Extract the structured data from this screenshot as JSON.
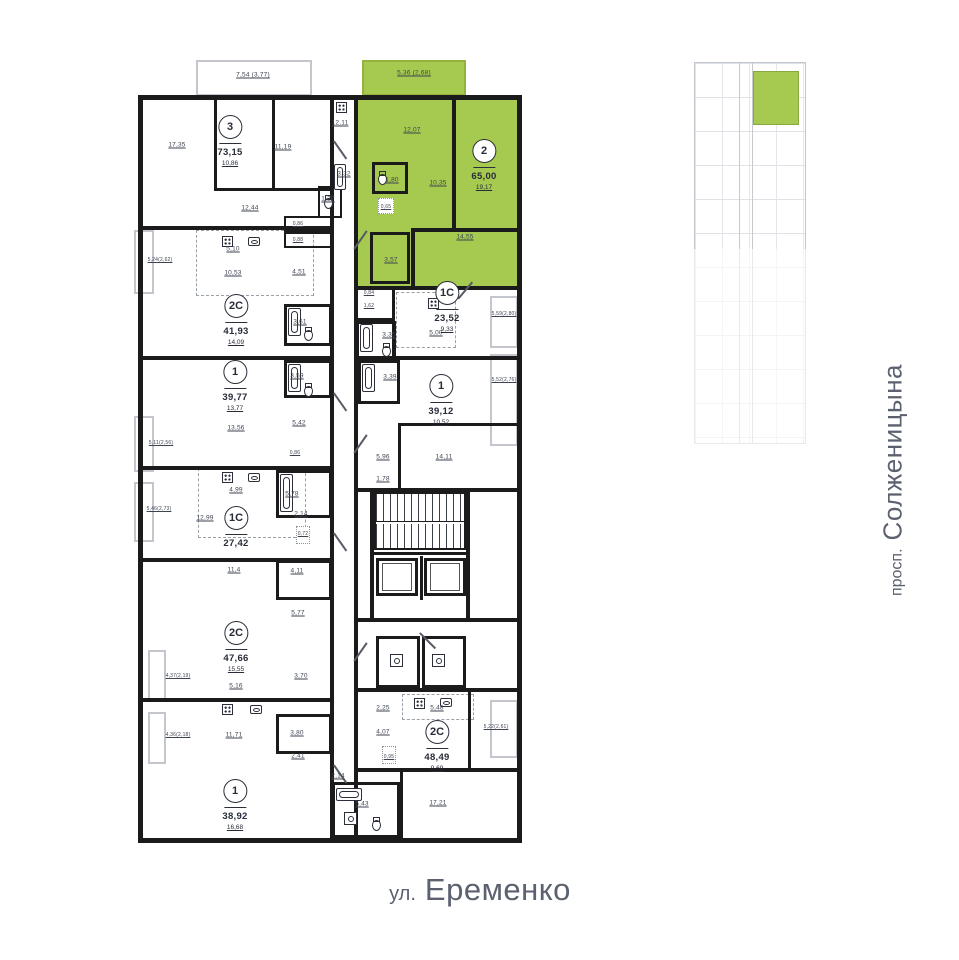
{
  "streets": {
    "bottom_prefix": "ул.",
    "bottom_name": "Еременко",
    "right_prefix": "просп.",
    "right_name": "Солженицына"
  },
  "colors": {
    "highlight": "#a6ca4f",
    "wall": "#1b1b1b",
    "balcony_line": "#c3c7cd",
    "street_text": "#5c6170"
  },
  "apartments": [
    {
      "type": "3",
      "area": "73,15",
      "living": "10,86",
      "rooms": {
        "bedroom1": "17,35",
        "bedroom2": "11,19",
        "hall": "12,44",
        "kitchen": "12,11",
        "bath": "3,32",
        "wc": "1,27",
        "balcony": "7,54 (3,77)"
      }
    },
    {
      "type": "2",
      "area": "65,00",
      "living": "19,17",
      "highlighted": true,
      "rooms": {
        "kitchen_living": "12,07",
        "hall": "10,35",
        "bedroom": "14,55",
        "bath": "1,80",
        "wardrobe": "3,57",
        "niche": "0,65",
        "balcony": "5,36 (2,68)"
      }
    },
    {
      "type": "2C",
      "area": "41,93",
      "living": "14,09",
      "rooms": {
        "kitchen": "5,10",
        "hall": "10,53",
        "corridor": "4,51",
        "bath": "3,61",
        "wc1": "0,86",
        "wc2": "0,88",
        "balcony": "5,24(2,62)"
      }
    },
    {
      "type": "1",
      "area": "39,77",
      "living": "13,77",
      "rooms": {
        "room": "13,56",
        "hall": "5,42",
        "bath": "3,59",
        "balcony": "5,11(2,56)"
      }
    },
    {
      "type": "1C",
      "area": "27,42",
      "living": "12,99",
      "rooms": {
        "kitchen": "4,99",
        "bath": "5,78",
        "corridor": "2,14",
        "niche": "0,72",
        "wc": "0,86",
        "balcony": "5,46(2,73)"
      }
    },
    {
      "type": "2C",
      "area": "47,66",
      "living": "15,55",
      "rooms": {
        "bedroom1": "11,4",
        "bath1": "4,11",
        "corridor": "5,77",
        "wardrobe": "3,70",
        "kitchen": "5,16",
        "bedroom2": "11,71",
        "bath2": "3,80",
        "hall": "2,41",
        "balcony1": "4,37(2,19)",
        "balcony2": "4,36(2,18)"
      }
    },
    {
      "type": "1",
      "area": "38,92",
      "living": "16,68",
      "rooms": {
        "corridor": "2,14",
        "bath": "5,43"
      }
    },
    {
      "type": "1C",
      "area": "23,52",
      "living": "9,33",
      "rooms": {
        "kitchen": "5,00",
        "corridor": "1,62",
        "wc": "0,84",
        "bath": "3,35",
        "balcony": "5,59(2,80)"
      }
    },
    {
      "type": "1",
      "area": "39,12",
      "living": "10,52",
      "rooms": {
        "room": "14,11",
        "kitchen": "5,96",
        "corridor": "1,78",
        "bath": "3,39",
        "balcony": "5,52(2,76)"
      }
    },
    {
      "type": "2C",
      "area": "48,49",
      "living": "9,69",
      "rooms": {
        "corridor": "2,25",
        "kitchen": "5,48",
        "hall": "4,07",
        "wc": "0,95",
        "room": "17,21",
        "balcony": "5,22(2,61)"
      }
    }
  ]
}
